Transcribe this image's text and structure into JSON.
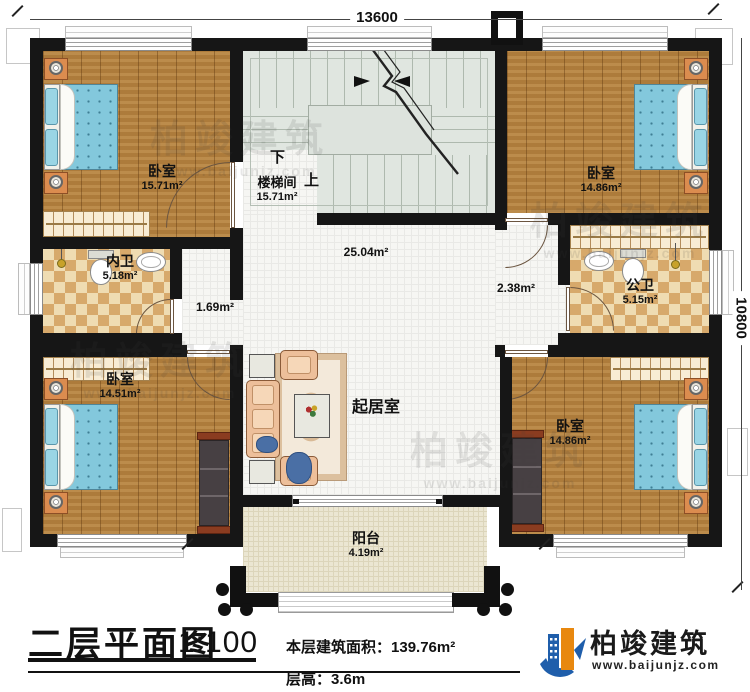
{
  "plan": {
    "dimensions": {
      "top": "13600",
      "right": "10800"
    },
    "rooms": {
      "bedroom_tl": {
        "name": "卧室",
        "area": "15.71m²"
      },
      "bedroom_tr": {
        "name": "卧室",
        "area": "14.86m²"
      },
      "bedroom_bl": {
        "name": "卧室",
        "area": "14.51m²"
      },
      "bedroom_br": {
        "name": "卧室",
        "area": "14.86m²"
      },
      "stairwell": {
        "name": "楼梯间",
        "area": "15.71m²",
        "down_label": "下",
        "up_label": "上"
      },
      "bath_inner": {
        "name": "内卫",
        "area": "5.18m²"
      },
      "bath_public": {
        "name": "公卫",
        "area": "5.15m²"
      },
      "hall": {
        "area": "25.04m²"
      },
      "corridor_left": {
        "area": "1.69m²"
      },
      "corridor_right": {
        "area": "2.38m²"
      },
      "living_room": {
        "name": "起居室"
      },
      "balcony": {
        "name": "阳台",
        "area": "4.19m²"
      }
    }
  },
  "title_block": {
    "title": "二层平面图",
    "scale": "1:100",
    "area_label": "本层建筑面积：",
    "area_value": "139.76m²",
    "floor_height_label": "层高：",
    "floor_height_value": "3.6m"
  },
  "logo": {
    "name": "柏竣建筑",
    "website": "www.baijunjz.com"
  },
  "watermark": {
    "name": "柏竣建筑",
    "website": "www.baijunjz.com"
  },
  "colors": {
    "wall": "#161616",
    "wood_floor": "#b5823f",
    "tile_dark": "#d7a96b",
    "tile_light": "#efdcb2",
    "stair_floor": "#e0e6e0",
    "balcony_floor": "#ebe6d2",
    "bed_blue": "#83c8dc",
    "sofa_peach": "#edbf9a",
    "logo_blue": "#1f5eab",
    "logo_orange": "#e8880f"
  }
}
